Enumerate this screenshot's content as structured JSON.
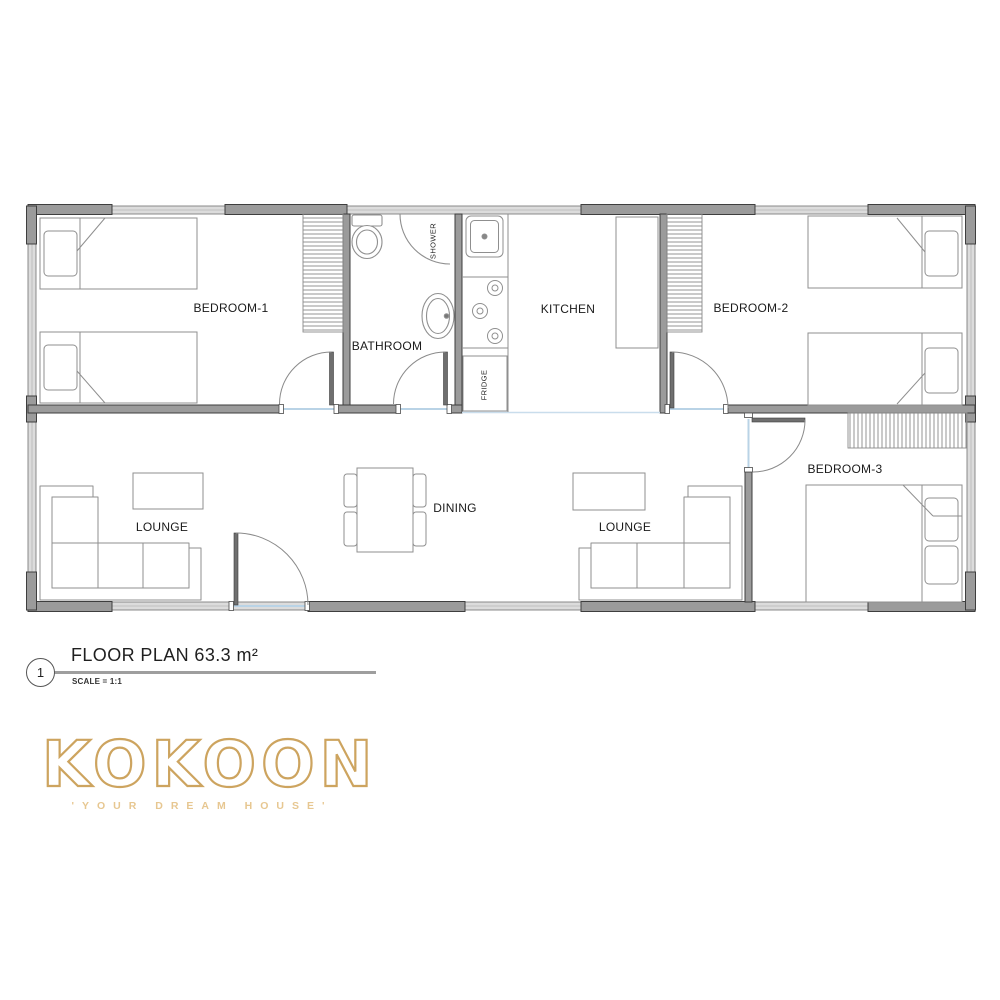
{
  "plan": {
    "rooms": [
      {
        "id": "bedroom-1",
        "label": "BEDROOM-1"
      },
      {
        "id": "bathroom",
        "label": "BATHROOM"
      },
      {
        "id": "kitchen",
        "label": "KITCHEN"
      },
      {
        "id": "bedroom-2",
        "label": "BEDROOM-2"
      },
      {
        "id": "bedroom-3",
        "label": "BEDROOM-3"
      },
      {
        "id": "lounge-1",
        "label": "LOUNGE"
      },
      {
        "id": "lounge-2",
        "label": "LOUNGE"
      },
      {
        "id": "dining",
        "label": "DINING"
      }
    ],
    "fixtures": [
      {
        "id": "shower",
        "label": "SHOWER"
      },
      {
        "id": "fridge",
        "label": "FRIDGE"
      }
    ]
  },
  "title_block": {
    "number": "1",
    "title": "FLOOR PLAN 63.3 m²",
    "scale": "SCALE = 1:1"
  },
  "logo": {
    "name": "KOKOON",
    "tagline": "'YOUR DREAM HOUSE'"
  },
  "colors": {
    "wall_fill": "#9b9b9b",
    "wall_outline": "#3e3e3e",
    "window_fill": "#dcdcdc",
    "furniture_line": "#8f8f8f",
    "door_threshold": "#b9d3e6",
    "label_text": "#1a1a1a",
    "logo_gold": "#cda45f",
    "tagline_gold": "#e7c791"
  }
}
